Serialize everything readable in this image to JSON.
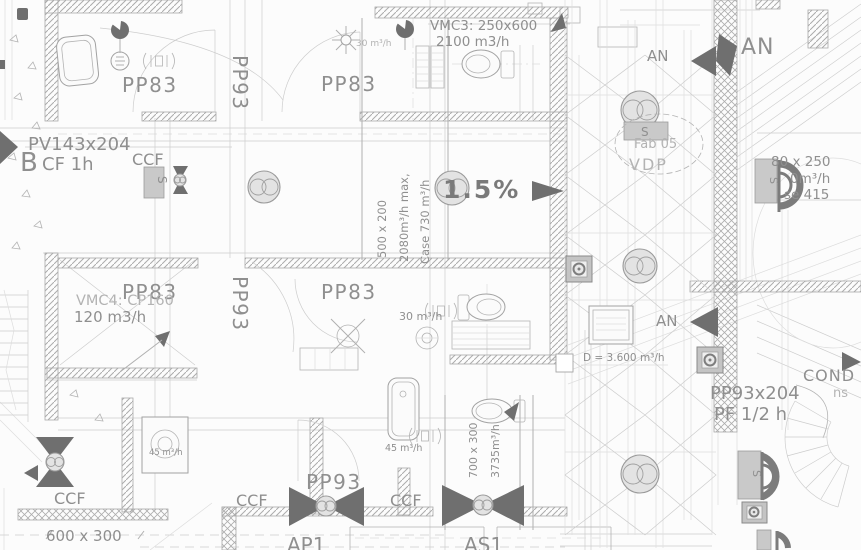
{
  "palette": {
    "background": "#fcfcfc",
    "line_light": "#cdcdcd",
    "line_medium": "#a9a9a9",
    "text_gray": "#8f8f8f",
    "text_faint": "#b3b3b3",
    "symbol_dark": "#6f6f6f",
    "fill_gray": "#c9c9c9"
  },
  "plan": {
    "room_labels": {
      "pp83": "PP83",
      "pp93": "PP93"
    },
    "door_labels": {
      "pv143x204": "PV143x204",
      "pp93x204": "PP93x204",
      "b_marker": "B"
    },
    "fire_ratings": {
      "cf_1h": "CF 1h",
      "pf_half_h": "PF 1/2 h"
    },
    "fire": {
      "ccf": "CCF"
    },
    "vmc": {
      "vmc3_ref": "VMC3: 250x600",
      "vmc3_flow": "2100 m3/h",
      "vmc4_ref": "VMC4: CP160",
      "vmc4_flow": "120 m3/h"
    },
    "ducts": {
      "size_500x200": "500 x 200",
      "max_flow": "2080m³/h max,",
      "case_flow": "Case 730 m³/h",
      "size_700x300": "700 x 300",
      "flow_3735": "3735m³/h",
      "size_600x300": "600 x 300",
      "size_80x250": "80 x 250",
      "flow_right": "0m³/h",
      "ref_415": "se 415",
      "d_3600": "D = 3.600 m³/h"
    },
    "flows": {
      "flow_30": "30 m³/h",
      "flow_45": "45 m³/h"
    },
    "slope_label": "1.5%",
    "air": {
      "an": "AN"
    },
    "annotations": {
      "fab05": "Fab 05",
      "vdp": "VDP",
      "cond": "COND",
      "ns": "ns",
      "ap1": "AP1",
      "as1": "AS1",
      "s_marker": "S"
    }
  }
}
